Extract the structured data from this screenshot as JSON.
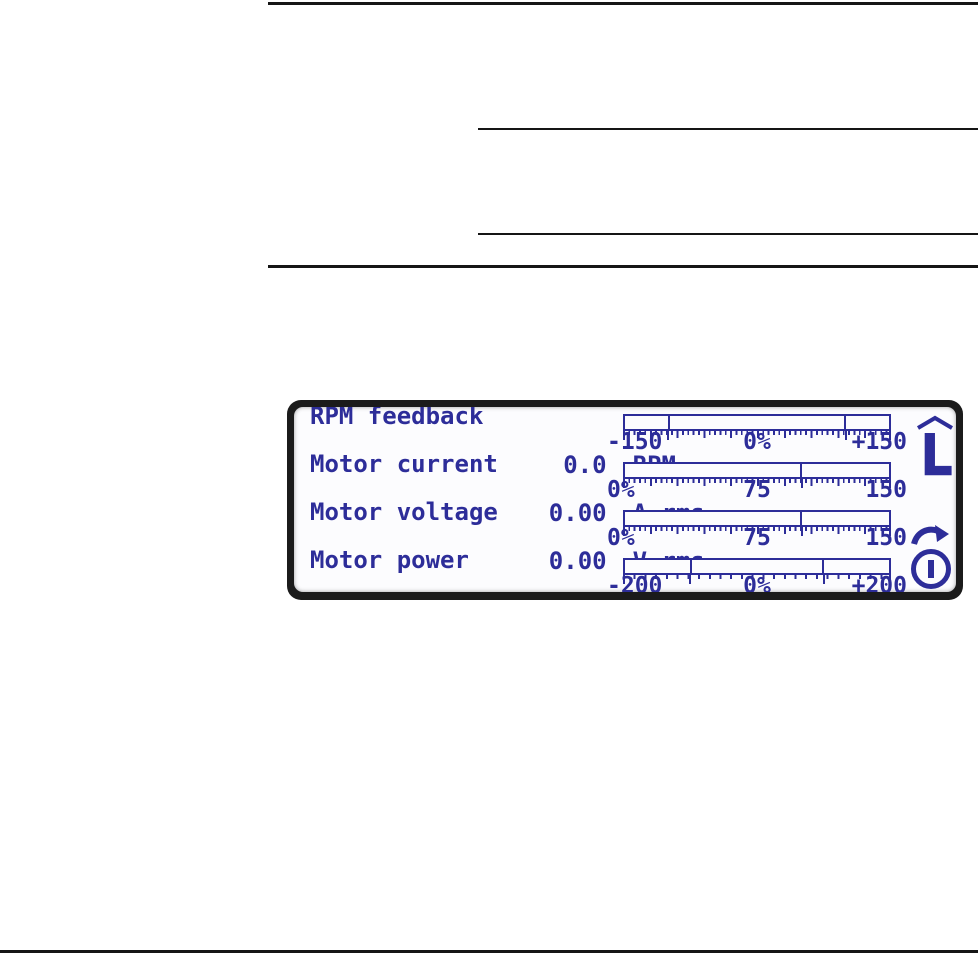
{
  "lcd_display": {
    "signals": [
      {
        "name": "RPM feedback",
        "value": "0.0",
        "unit": "RPM",
        "scale": {
          "min": "-150",
          "mid": "0%",
          "max": "+150"
        },
        "marker_positions_pct": [
          16.7,
          83.3
        ]
      },
      {
        "name": "Motor current",
        "value": "0.00",
        "unit": "A rms",
        "scale": {
          "min": "0%",
          "mid": "75",
          "max": "150"
        },
        "marker_positions_pct": [
          66.7
        ]
      },
      {
        "name": "Motor voltage",
        "value": "0.00",
        "unit": "V rms",
        "scale": {
          "min": "0%",
          "mid": "75",
          "max": "150"
        },
        "marker_positions_pct": [
          66.7
        ]
      },
      {
        "name": "Motor power",
        "value": "0.00",
        "unit": "KW",
        "scale": {
          "min": "-200",
          "mid": "0%",
          "max": "+200"
        },
        "marker_positions_pct": [
          25,
          75
        ]
      }
    ],
    "status": {
      "control_location": "L",
      "icons": [
        "chevron-up-icon",
        "local-control-letter",
        "rotation-direction-icon",
        "stop-status-icon"
      ]
    },
    "colors": {
      "lcd_ink": "#2d2d99",
      "bezel": "#1b1b1b",
      "screen_bg": "#fcfcfe"
    }
  }
}
